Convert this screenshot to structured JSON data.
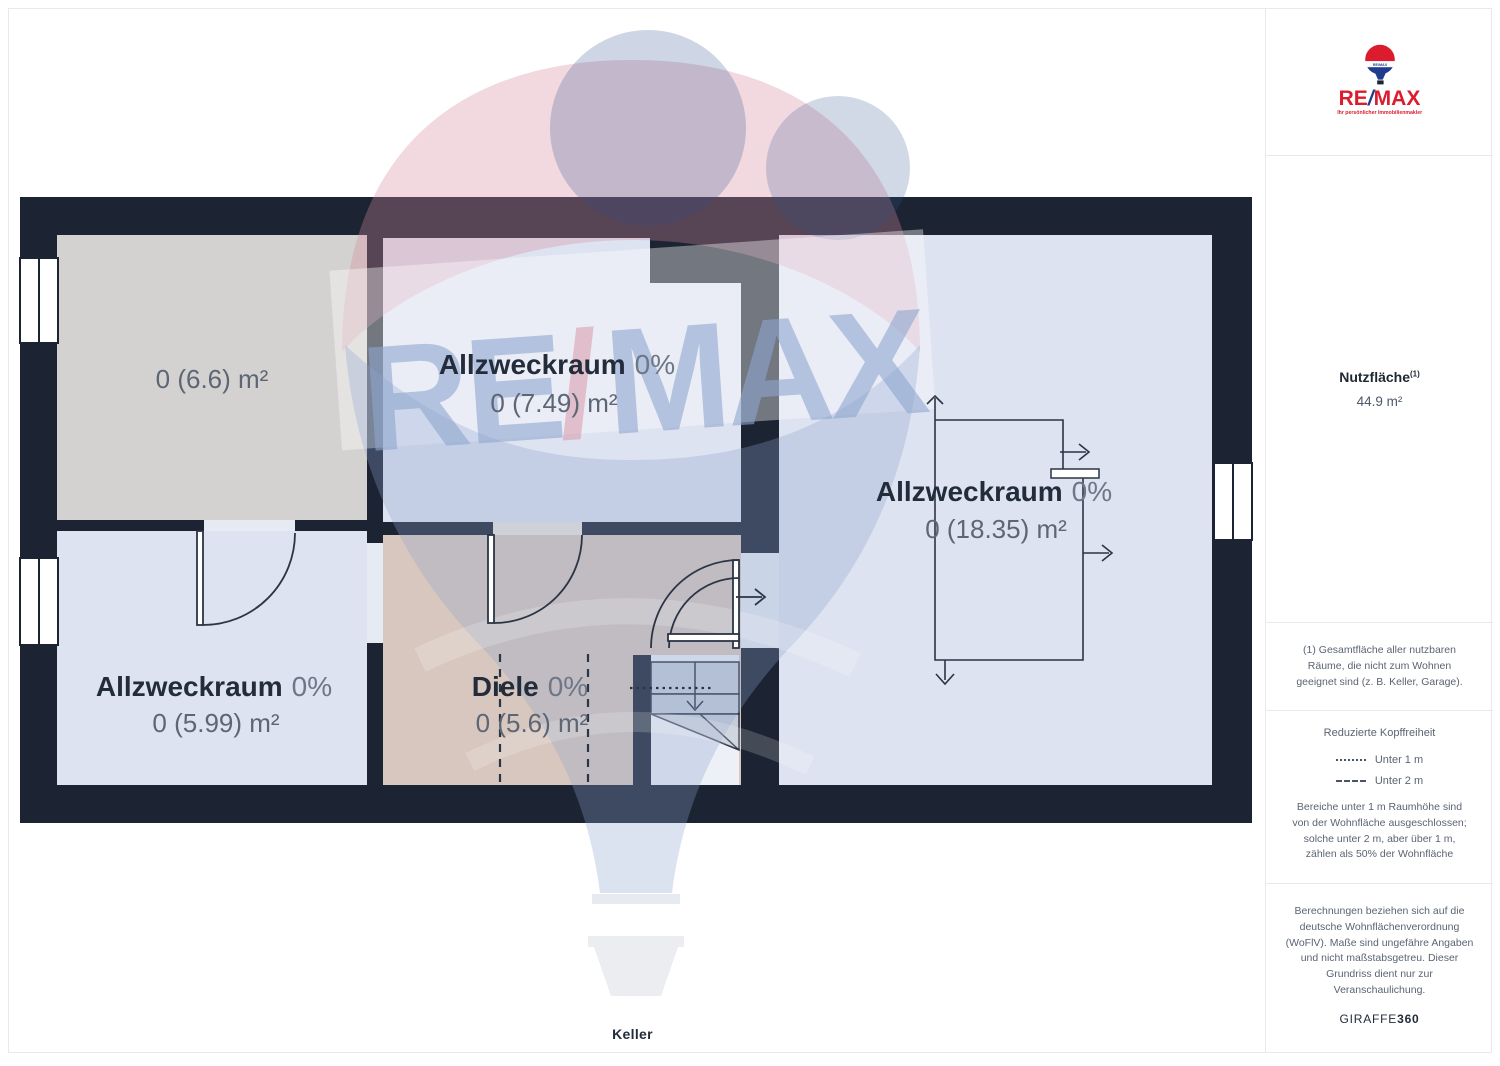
{
  "page": {
    "floor_label": "Keller"
  },
  "watermark": {
    "re": "RE",
    "slash": "/",
    "max": "MAX"
  },
  "floorplan": {
    "rooms": {
      "storage": {
        "area": "0 (6.6) m²"
      },
      "utility_top": {
        "name": "Allzweckraum",
        "percent": "0%",
        "area": "0 (7.49) m²"
      },
      "utility_right": {
        "name": "Allzweckraum",
        "percent": "0%",
        "area": "0 (18.35) m²"
      },
      "utility_bottom_left": {
        "name": "Allzweckraum",
        "percent": "0%",
        "area": "0 (5.99) m²"
      },
      "hallway": {
        "name": "Diele",
        "percent": "0%",
        "area": "0 (5.6) m²"
      }
    },
    "colors": {
      "wall": "#1c2433",
      "room_blue": "#dde3f0",
      "room_gray": "#d4d2d0",
      "room_tan": "#d7c7be",
      "stair": "#c6cdd9",
      "line": "#2b3545"
    }
  },
  "sidebar": {
    "logo": {
      "brand_re": "RE",
      "brand_slash": "/",
      "brand_max": "MAX",
      "balloon_text": "RE/MAX",
      "tagline": "Ihr persönlicher Immobilienmakler",
      "red": "#dc1c2e",
      "blue": "#1f3d8c"
    },
    "area_summary": {
      "title": "Nutzfläche",
      "sup": "(1)",
      "value": "44.9 m²"
    },
    "footnote": "(1) Gesamtfläche aller nutzbaren\nRäume, die nicht zum Wohnen\ngeeignet sind (z. B. Keller, Garage).",
    "legend": {
      "title": "Reduzierte Kopffreiheit",
      "items": [
        {
          "style": "dotted",
          "label": "Unter 1 m"
        },
        {
          "style": "dashed",
          "label": "Unter 2 m"
        }
      ],
      "description": "Bereiche unter 1 m Raumhöhe sind\nvon der Wohnfläche ausgeschlossen;\nsolche unter 2 m, aber über 1 m,\nzählen als 50% der Wohnfläche"
    },
    "disclaimer": "Berechnungen beziehen sich auf die\ndeutsche Wohnflächenverordnung\n(WoFlV). Maße sind ungefähre Angaben\nund nicht maßstabsgetreu. Dieser\nGrundriss dient nur zur\nVeranschaulichung.",
    "brand_footer": {
      "normal": "GIRAFFE",
      "bold": "360"
    }
  }
}
